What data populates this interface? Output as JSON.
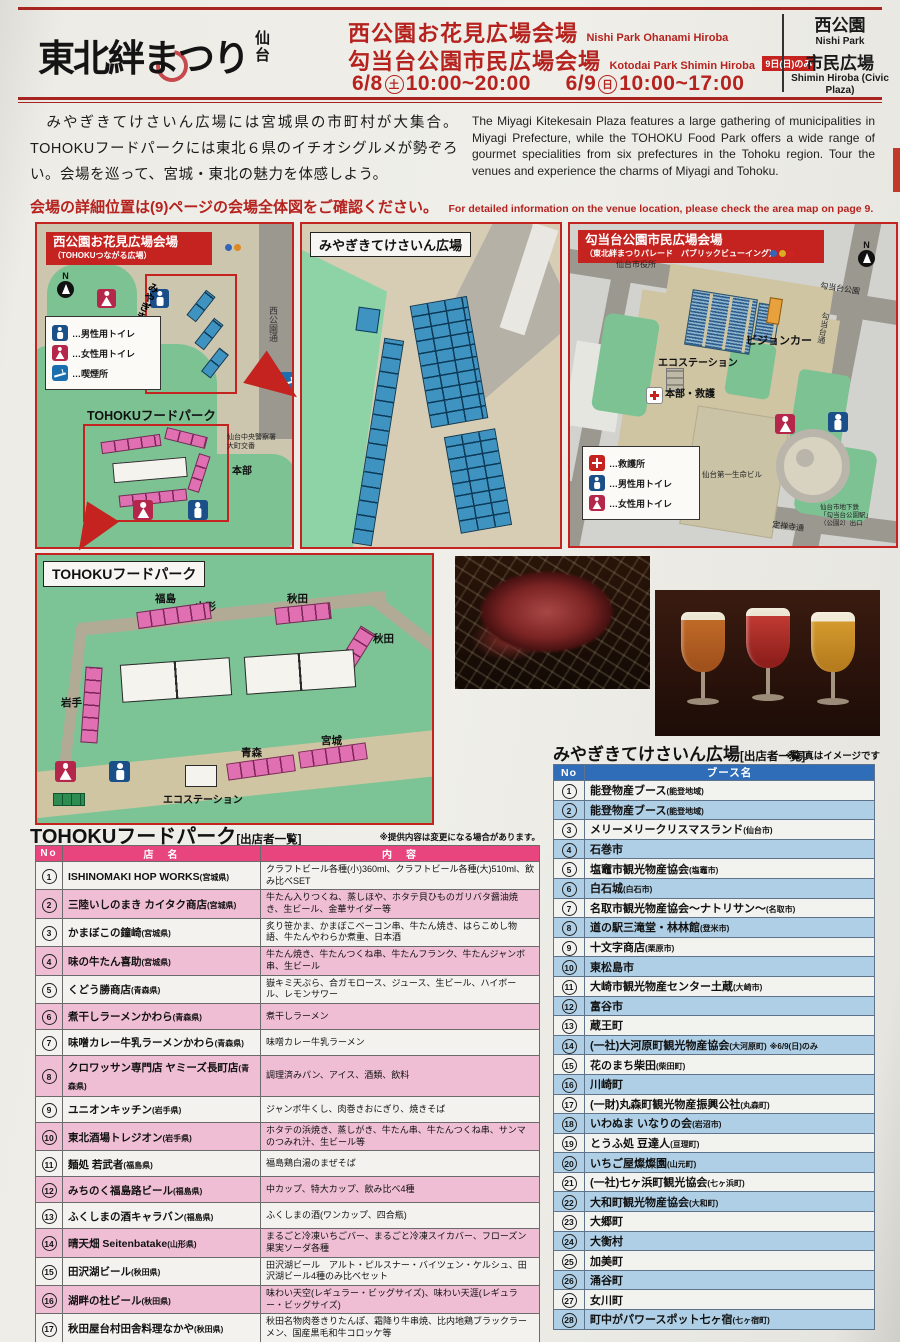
{
  "colors": {
    "accent_red": "#c4231f",
    "table1_header_pink": "#e8447e",
    "table2_header_blue": "#2f6db8",
    "booth_pink": "#e070b2",
    "booth_blue": "#3f93c0",
    "map_green": "#7cc293"
  },
  "header": {
    "logo_main": "東北絆まつり",
    "logo_sub": "仙台",
    "venue1_jp": "西公園お花見広場会場",
    "venue1_en": "Nishi Park Ohanami Hiroba",
    "venue2_jp": "勾当台公園市民広場会場",
    "venue2_en": "Kotodai Park Shimin Hiroba",
    "venue2_badge": "9日(日)のみ",
    "date1_prefix": "6/8",
    "date1_day": "土",
    "date1_time": "10:00~20:00",
    "date2_prefix": "6/9",
    "date2_day": "日",
    "date2_time": "10:00~17:00",
    "side_box": {
      "line1_jp": "西公園",
      "line1_en": "Nishi Park",
      "line2_jp": "市民広場",
      "line2_en": "Shimin Hiroba (Civic Plaza)"
    }
  },
  "intro": {
    "jp": "　みやぎきてけさいん広場には宮城県の市町村が大集合。TOHOKUフードパークには東北６県のイチオシグルメが勢ぞろい。会場を巡って、宮城・東北の魅力を体感しよう。",
    "en": "The Miyagi Kitekesain Plaza features a large gathering of municipalities in Miyagi Prefecture, while the TOHOKU Food Park offers a wide range of gourmet specialities from six prefectures in the Tohoku region. Tour the venues and experience the charms of Miyagi and Tohoku."
  },
  "notice": {
    "jp": "会場の詳細位置は(9)ページの会場全体図をご確認ください。",
    "en": "For detailed information on the venue location, please check the area map on page 9."
  },
  "maps": {
    "nishi": {
      "title": "西公園お花見広場会場",
      "subtitle": "（TOHOKUつながる広場）",
      "compass": "N",
      "plaza_label": "みやぎきてけさいん広場",
      "foodpark_label": "TOHOKUフードパーク",
      "police_label": "仙台中央警察署\n大町交番",
      "honbu_label": "本部",
      "street_label": "西公園通",
      "legend": [
        {
          "icon": "male-toilet-icon",
          "label": "…男性用トイレ"
        },
        {
          "icon": "female-toilet-icon",
          "label": "…女性用トイレ"
        },
        {
          "icon": "smoking-icon",
          "label": "…喫煙所"
        }
      ]
    },
    "kitekesain": {
      "title": "みやぎきてけさいん広場"
    },
    "kotodai": {
      "title": "勾当台公園市民広場会場",
      "subtitle": "（東北絆まつりパレード　パブリックビューイング）",
      "compass": "N",
      "city_hall": "仙台市役所",
      "park_label": "勾当台公園",
      "street_right": "勾当台通",
      "vision_car": "ビジョンカー",
      "eco_station": "エコステーション",
      "honbu": "本部・救護",
      "building": "仙台第一生命ビル",
      "alley": "つなぎ横丁",
      "street_bottom": "定禅寺通",
      "subway": "仙台市地下鉄\n「勾当台公園駅」\n（公園2）出口",
      "legend": [
        {
          "icon": "first-aid-icon",
          "label": "…救護所"
        },
        {
          "icon": "male-toilet-icon",
          "label": "…男性用トイレ"
        },
        {
          "icon": "female-toilet-icon",
          "label": "…女性用トイレ"
        }
      ]
    },
    "foodpark": {
      "title": "TOHOKUフードパーク",
      "labels": {
        "fukushima": "福島",
        "yamagata": "山形",
        "akita_top": "秋田",
        "akita_right": "秋田",
        "iwate": "岩手",
        "aomori": "青森",
        "miyagi": "宮城",
        "eco": "エコステーション"
      }
    }
  },
  "photos": {
    "caption": "※写真はイメージです"
  },
  "table_foodpark": {
    "heading": "TOHOKUフードパーク",
    "heading_suffix": "[出店者一覧]",
    "note": "※提供内容は変更になる場合があります。",
    "columns": [
      "No",
      "店　名",
      "内　容"
    ],
    "rows": [
      {
        "no": "1",
        "name": "ISHINOMAKI HOP WORKS",
        "pref": "(宮城県)",
        "desc": "クラフトビール各種(小)360ml、クラフトビール各種(大)510ml、飲み比べSET"
      },
      {
        "no": "2",
        "name": "三陸いしのまき カイタク商店",
        "pref": "(宮城県)",
        "desc": "牛たん入りつくね、蒸しほや、ホタテ貝ひものガリバタ醤油焼き、生ビール、金華サイダー等"
      },
      {
        "no": "3",
        "name": "かまぼこの鐘崎",
        "pref": "(宮城県)",
        "desc": "炙り笹かま、かまぼこベーコン串、牛たん焼き、はらこめし物語、牛たんやわらか煮重、日本酒"
      },
      {
        "no": "4",
        "name": "味の牛たん喜助",
        "pref": "(宮城県)",
        "desc": "牛たん焼き、牛たんつくね串、牛たんフランク、牛たんジャンボ串、生ビール"
      },
      {
        "no": "5",
        "name": "くどう勝商店",
        "pref": "(青森県)",
        "desc": "嶽キミ天ぷら、合ガモロース、ジュース、生ビール、ハイボール、レモンサワー"
      },
      {
        "no": "6",
        "name": "煮干しラーメンかわら",
        "pref": "(青森県)",
        "desc": "煮干しラーメン"
      },
      {
        "no": "7",
        "name": "味噌カレー牛乳ラーメンかわら",
        "pref": "(青森県)",
        "desc": "味噌カレー牛乳ラーメン"
      },
      {
        "no": "8",
        "name": "クロワッサン専門店 ヤミーズ長町店",
        "pref": "(青森県)",
        "desc": "調理済みパン、アイス、酒類、飲料"
      },
      {
        "no": "9",
        "name": "ユニオンキッチン",
        "pref": "(岩手県)",
        "desc": "ジャンボ牛くし、肉巻きおにぎり、焼きそば"
      },
      {
        "no": "10",
        "name": "東北酒場トレジオン",
        "pref": "(岩手県)",
        "desc": "ホタテの浜焼き、蒸しがき、牛たん串、牛たんつくね串、サンマのつみれ汁、生ビール等"
      },
      {
        "no": "11",
        "name": "麺処 若武者",
        "pref": "(福島県)",
        "desc": "福島鶏白湯のまぜそば"
      },
      {
        "no": "12",
        "name": "みちのく福島路ビール",
        "pref": "(福島県)",
        "desc": "中カップ、特大カップ、飲み比べ4種"
      },
      {
        "no": "13",
        "name": "ふくしまの酒キャラバン",
        "pref": "(福島県)",
        "desc": "ふくしまの酒(ワンカップ、四合瓶)"
      },
      {
        "no": "14",
        "name": "晴天畑 Seitenbatake",
        "pref": "(山形県)",
        "desc": "まるごと冷凍いちごバー、まるごと冷凍スイカバー、フローズン果実ソーダ各種"
      },
      {
        "no": "15",
        "name": "田沢湖ビール",
        "pref": "(秋田県)",
        "desc": "田沢湖ビール　アルト・ピルスナー・バイツェン・ケルシュ、田沢湖ビール4種のみ比べセット"
      },
      {
        "no": "16",
        "name": "湖畔の杜ビール",
        "pref": "(秋田県)",
        "desc": "味わい天空(レギュラー・ビッグサイズ)、味わい天涯(レギュラー・ビッグサイズ)"
      },
      {
        "no": "17",
        "name": "秋田屋台村田舎料理なかや",
        "pref": "(秋田県)",
        "desc": "秋田名物肉巻きりたんぽ、霜降り牛串焼、比内地鶏ブラックラーメン、国産黒毛和牛コロッケ等"
      },
      {
        "no": "18",
        "name": "有限会社進藤冷菓",
        "pref": "(秋田県)",
        "desc": "ババヘラ・アイス、男鹿しょっつる焼きそば、男鹿しょっつる唐揚げ、秋田雪(かき氷)など"
      },
      {
        "no": "19",
        "name": "由利屋",
        "pref": "(秋田県)",
        "desc": "横手やきそば、からあげ、由利牛串、由利牛巻きたんぽ"
      }
    ]
  },
  "table_kitekesain": {
    "heading": "みやぎきてけさいん広場",
    "heading_suffix": "[出店者一覧]",
    "columns": [
      "No",
      "ブース名"
    ],
    "rows": [
      {
        "no": "1",
        "name": "能登物産ブース",
        "pref": "(能登地域)",
        "note": ""
      },
      {
        "no": "2",
        "name": "能登物産ブース",
        "pref": "(能登地域)",
        "note": ""
      },
      {
        "no": "3",
        "name": "メリーメリークリスマスランド",
        "pref": "(仙台市)",
        "note": ""
      },
      {
        "no": "4",
        "name": "石巻市",
        "pref": "",
        "note": ""
      },
      {
        "no": "5",
        "name": "塩竈市観光物産協会",
        "pref": "(塩竈市)",
        "note": ""
      },
      {
        "no": "6",
        "name": "白石城",
        "pref": "(白石市)",
        "note": ""
      },
      {
        "no": "7",
        "name": "名取市観光物産協会～ナトリサン～",
        "pref": "(名取市)",
        "note": ""
      },
      {
        "no": "8",
        "name": "道の駅三滝堂・林林館",
        "pref": "(登米市)",
        "note": ""
      },
      {
        "no": "9",
        "name": "十文字商店",
        "pref": "(栗原市)",
        "note": ""
      },
      {
        "no": "10",
        "name": "東松島市",
        "pref": "",
        "note": ""
      },
      {
        "no": "11",
        "name": "大崎市観光物産センター土蔵",
        "pref": "(大崎市)",
        "note": ""
      },
      {
        "no": "12",
        "name": "富谷市",
        "pref": "",
        "note": ""
      },
      {
        "no": "13",
        "name": "蔵王町",
        "pref": "",
        "note": ""
      },
      {
        "no": "14",
        "name": "(一社)大河原町観光物産協会",
        "pref": "(大河原町)",
        "note": "※6/9(日)のみ"
      },
      {
        "no": "15",
        "name": "花のまち柴田",
        "pref": "(柴田町)",
        "note": ""
      },
      {
        "no": "16",
        "name": "川崎町",
        "pref": "",
        "note": ""
      },
      {
        "no": "17",
        "name": "(一財)丸森町観光物産振興公社",
        "pref": "(丸森町)",
        "note": ""
      },
      {
        "no": "18",
        "name": "いわぬま いなりの会",
        "pref": "(岩沼市)",
        "note": ""
      },
      {
        "no": "19",
        "name": "とうふ処 豆達人",
        "pref": "(亘理町)",
        "note": ""
      },
      {
        "no": "20",
        "name": "いちご屋燦燦園",
        "pref": "(山元町)",
        "note": ""
      },
      {
        "no": "21",
        "name": "(一社)七ヶ浜町観光協会",
        "pref": "(七ヶ浜町)",
        "note": ""
      },
      {
        "no": "22",
        "name": "大和町観光物産協会",
        "pref": "(大和町)",
        "note": ""
      },
      {
        "no": "23",
        "name": "大郷町",
        "pref": "",
        "note": ""
      },
      {
        "no": "24",
        "name": "大衡村",
        "pref": "",
        "note": ""
      },
      {
        "no": "25",
        "name": "加美町",
        "pref": "",
        "note": ""
      },
      {
        "no": "26",
        "name": "涌谷町",
        "pref": "",
        "note": ""
      },
      {
        "no": "27",
        "name": "女川町",
        "pref": "",
        "note": ""
      },
      {
        "no": "28",
        "name": "町中がパワースポット七ヶ宿",
        "pref": "(七ヶ宿町)",
        "note": ""
      }
    ]
  }
}
